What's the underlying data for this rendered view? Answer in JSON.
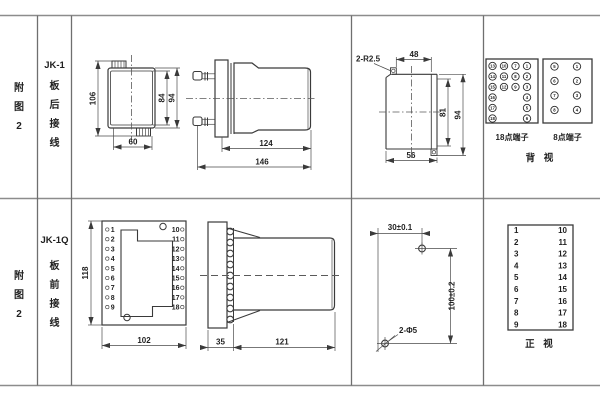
{
  "rows": {
    "top": {
      "figure_chars": [
        "附",
        "图",
        "2"
      ],
      "model": "JK-1",
      "wiring_chars": [
        "板",
        "后",
        "接",
        "线"
      ],
      "front_view": {
        "dim_overall_height": "106",
        "dim_inner_height": "84",
        "dim_case_height": "94",
        "dim_width": "60"
      },
      "side_view": {
        "dim_body_length": "124",
        "dim_total_length": "146"
      },
      "cutout_view": {
        "corner_note": "2-R2.5",
        "dim_top_width": "48",
        "dim_inner_height": "81",
        "dim_outer_height": "94",
        "dim_bottom_width": "56"
      },
      "rear_view": {
        "label_18": "18点端子",
        "label_8": "8点端子",
        "view_label": "背 视",
        "t18": [
          [
            "13",
            "10",
            "7",
            "1"
          ],
          [
            "14",
            "11",
            "8",
            "2"
          ],
          [
            "15",
            "12",
            "9",
            "3"
          ],
          [
            "16",
            "4"
          ],
          [
            "17",
            "5"
          ],
          [
            "18",
            "6"
          ]
        ],
        "t8": [
          [
            "5",
            "1"
          ],
          [
            "6",
            "2"
          ],
          [
            "7",
            "3"
          ],
          [
            "8",
            "4"
          ]
        ]
      }
    },
    "bottom": {
      "figure_chars": [
        "附",
        "图",
        "2"
      ],
      "model": "JK-1Q",
      "wiring_chars": [
        "板",
        "前",
        "接",
        "线"
      ],
      "front_view": {
        "dim_height": "118",
        "dim_width": "102",
        "left_terminals": [
          "1",
          "2",
          "3",
          "4",
          "5",
          "6",
          "7",
          "8",
          "9"
        ],
        "right_terminals": [
          "10",
          "11",
          "12",
          "13",
          "14",
          "15",
          "16",
          "17",
          "18"
        ]
      },
      "side_view": {
        "dim_plate": "35",
        "dim_body_length": "121"
      },
      "drill_view": {
        "dim_horizontal": "30±0.1",
        "dim_vertical": "100±0.2",
        "hole_note": "2-Φ5"
      },
      "front_table": {
        "left": [
          "1",
          "2",
          "3",
          "4",
          "5",
          "6",
          "7",
          "8",
          "9"
        ],
        "right": [
          "10",
          "11",
          "12",
          "13",
          "14",
          "15",
          "16",
          "17",
          "18"
        ],
        "view_label": "正 视"
      }
    }
  }
}
